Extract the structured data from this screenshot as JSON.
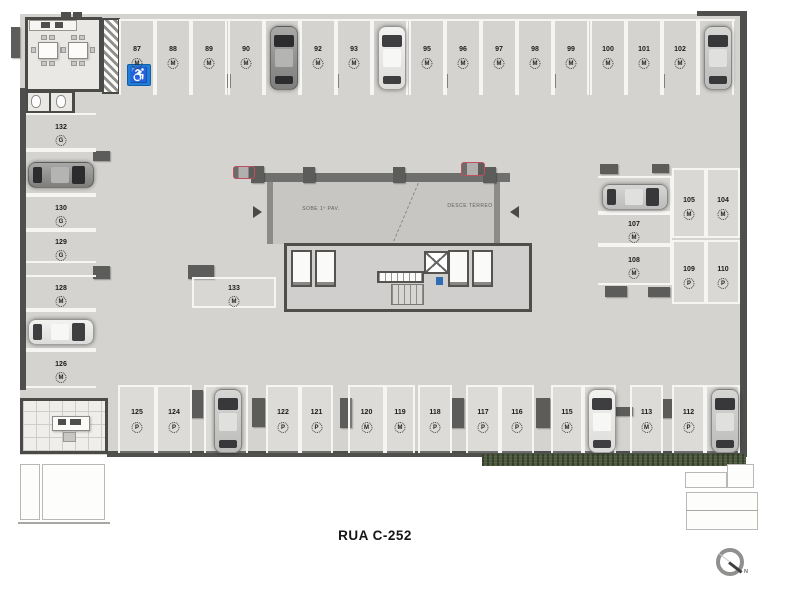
{
  "title": {
    "street": "RUA C-252"
  },
  "ramp": {
    "up": "SOBE 1º PAV.",
    "down": "DESCE TÉRREO"
  },
  "compass": {
    "north": "N"
  },
  "icons": {
    "wheelchair": "♿"
  },
  "spaces": [
    {
      "num": "87",
      "type": "M",
      "x": 119,
      "y": 20,
      "w": 36,
      "h": 75,
      "o": "v",
      "g": "top",
      "handicap": true
    },
    {
      "num": "88",
      "type": "M",
      "x": 155,
      "y": 20,
      "w": 36,
      "h": 75,
      "o": "v",
      "g": "top"
    },
    {
      "num": "89",
      "type": "M",
      "x": 191,
      "y": 20,
      "w": 36,
      "h": 75,
      "o": "v",
      "g": "top"
    },
    {
      "num": "90",
      "type": "M",
      "x": 228,
      "y": 20,
      "w": 36,
      "h": 75,
      "o": "v",
      "g": "top"
    },
    {
      "num": "91",
      "type": "M",
      "x": 264,
      "y": 20,
      "w": 36,
      "h": 75,
      "o": "v",
      "g": "top",
      "car": "gray"
    },
    {
      "num": "92",
      "type": "M",
      "x": 300,
      "y": 20,
      "w": 36,
      "h": 75,
      "o": "v",
      "g": "top"
    },
    {
      "num": "93",
      "type": "M",
      "x": 336,
      "y": 20,
      "w": 36,
      "h": 75,
      "o": "v",
      "g": "top"
    },
    {
      "num": "94",
      "type": "M",
      "x": 372,
      "y": 20,
      "w": 36,
      "h": 75,
      "o": "v",
      "g": "top",
      "car": "white"
    },
    {
      "num": "95",
      "type": "M",
      "x": 409,
      "y": 20,
      "w": 36,
      "h": 75,
      "o": "v",
      "g": "top"
    },
    {
      "num": "96",
      "type": "M",
      "x": 445,
      "y": 20,
      "w": 36,
      "h": 75,
      "o": "v",
      "g": "top"
    },
    {
      "num": "97",
      "type": "M",
      "x": 481,
      "y": 20,
      "w": 36,
      "h": 75,
      "o": "v",
      "g": "top"
    },
    {
      "num": "98",
      "type": "M",
      "x": 517,
      "y": 20,
      "w": 36,
      "h": 75,
      "o": "v",
      "g": "top"
    },
    {
      "num": "99",
      "type": "M",
      "x": 553,
      "y": 20,
      "w": 36,
      "h": 75,
      "o": "v",
      "g": "top"
    },
    {
      "num": "100",
      "type": "M",
      "x": 590,
      "y": 20,
      "w": 36,
      "h": 75,
      "o": "v",
      "g": "top"
    },
    {
      "num": "101",
      "type": "M",
      "x": 626,
      "y": 20,
      "w": 36,
      "h": 75,
      "o": "v",
      "g": "top"
    },
    {
      "num": "102",
      "type": "M",
      "x": 662,
      "y": 20,
      "w": 36,
      "h": 75,
      "o": "v",
      "g": "top"
    },
    {
      "num": "103",
      "type": "M",
      "x": 698,
      "y": 20,
      "w": 36,
      "h": 75,
      "o": "v",
      "g": "top",
      "car": "silver"
    },
    {
      "num": "132",
      "type": "G",
      "x": 26,
      "y": 113,
      "w": 70,
      "h": 37,
      "o": "h",
      "g": "left"
    },
    {
      "num": "131",
      "type": "G",
      "x": 26,
      "y": 150,
      "w": 70,
      "h": 45,
      "o": "h",
      "g": "left",
      "car": "gray"
    },
    {
      "num": "130",
      "type": "G",
      "x": 26,
      "y": 195,
      "w": 70,
      "h": 35,
      "o": "h",
      "g": "left"
    },
    {
      "num": "129",
      "type": "G",
      "x": 26,
      "y": 230,
      "w": 70,
      "h": 33,
      "o": "h",
      "g": "left"
    },
    {
      "num": "128",
      "type": "M",
      "x": 26,
      "y": 275,
      "w": 70,
      "h": 35,
      "o": "h",
      "g": "left"
    },
    {
      "num": "127",
      "type": "M",
      "x": 26,
      "y": 310,
      "w": 70,
      "h": 40,
      "o": "h",
      "g": "left",
      "car": "white"
    },
    {
      "num": "126",
      "type": "M",
      "x": 26,
      "y": 350,
      "w": 70,
      "h": 38,
      "o": "h",
      "g": "left"
    },
    {
      "num": "133",
      "type": "M",
      "x": 192,
      "y": 277,
      "w": 84,
      "h": 31,
      "o": "h",
      "g": "mid"
    },
    {
      "num": "106",
      "type": "M",
      "x": 598,
      "y": 176,
      "w": 74,
      "h": 37,
      "o": "h",
      "g": "rightH",
      "car": "silver"
    },
    {
      "num": "107",
      "type": "M",
      "x": 598,
      "y": 213,
      "w": 74,
      "h": 32,
      "o": "h",
      "g": "rightH"
    },
    {
      "num": "108",
      "type": "M",
      "x": 598,
      "y": 245,
      "w": 74,
      "h": 40,
      "o": "h",
      "g": "rightH"
    },
    {
      "num": "105",
      "type": "M",
      "x": 672,
      "y": 168,
      "w": 34,
      "h": 70,
      "o": "v",
      "g": "rightV"
    },
    {
      "num": "104",
      "type": "M",
      "x": 706,
      "y": 168,
      "w": 34,
      "h": 70,
      "o": "v",
      "g": "rightV"
    },
    {
      "num": "109",
      "type": "P",
      "x": 672,
      "y": 240,
      "w": 34,
      "h": 64,
      "o": "v",
      "g": "rightV"
    },
    {
      "num": "110",
      "type": "P",
      "x": 706,
      "y": 240,
      "w": 34,
      "h": 64,
      "o": "v",
      "g": "rightV"
    },
    {
      "num": "125",
      "type": "P",
      "x": 118,
      "y": 385,
      "w": 38,
      "h": 68,
      "o": "v",
      "g": "bottom"
    },
    {
      "num": "124",
      "type": "P",
      "x": 156,
      "y": 385,
      "w": 36,
      "h": 68,
      "o": "v",
      "g": "bottom"
    },
    {
      "num": "123",
      "type": "P",
      "x": 204,
      "y": 385,
      "w": 44,
      "h": 68,
      "o": "v",
      "g": "bottom",
      "car": "silver"
    },
    {
      "num": "122",
      "type": "P",
      "x": 266,
      "y": 385,
      "w": 34,
      "h": 68,
      "o": "v",
      "g": "bottom"
    },
    {
      "num": "121",
      "type": "P",
      "x": 300,
      "y": 385,
      "w": 33,
      "h": 68,
      "o": "v",
      "g": "bottom"
    },
    {
      "num": "120",
      "type": "M",
      "x": 348,
      "y": 385,
      "w": 37,
      "h": 68,
      "o": "v",
      "g": "bottom"
    },
    {
      "num": "119",
      "type": "M",
      "x": 385,
      "y": 385,
      "w": 30,
      "h": 68,
      "o": "v",
      "g": "bottom"
    },
    {
      "num": "118",
      "type": "P",
      "x": 418,
      "y": 385,
      "w": 34,
      "h": 68,
      "o": "v",
      "g": "bottom"
    },
    {
      "num": "117",
      "type": "P",
      "x": 466,
      "y": 385,
      "w": 34,
      "h": 68,
      "o": "v",
      "g": "bottom"
    },
    {
      "num": "116",
      "type": "P",
      "x": 500,
      "y": 385,
      "w": 34,
      "h": 68,
      "o": "v",
      "g": "bottom"
    },
    {
      "num": "115",
      "type": "M",
      "x": 551,
      "y": 385,
      "w": 32,
      "h": 68,
      "o": "v",
      "g": "bottom"
    },
    {
      "num": "114",
      "type": "M",
      "x": 583,
      "y": 385,
      "w": 33,
      "h": 68,
      "o": "v",
      "g": "bottom",
      "car": "white"
    },
    {
      "num": "113",
      "type": "M",
      "x": 630,
      "y": 385,
      "w": 33,
      "h": 68,
      "o": "v",
      "g": "bottom"
    },
    {
      "num": "112",
      "type": "P",
      "x": 672,
      "y": 385,
      "w": 33,
      "h": 68,
      "o": "v",
      "g": "bottom"
    },
    {
      "num": "111",
      "type": "P",
      "x": 705,
      "y": 385,
      "w": 35,
      "h": 68,
      "o": "v",
      "g": "bottom",
      "car": "silver"
    }
  ]
}
